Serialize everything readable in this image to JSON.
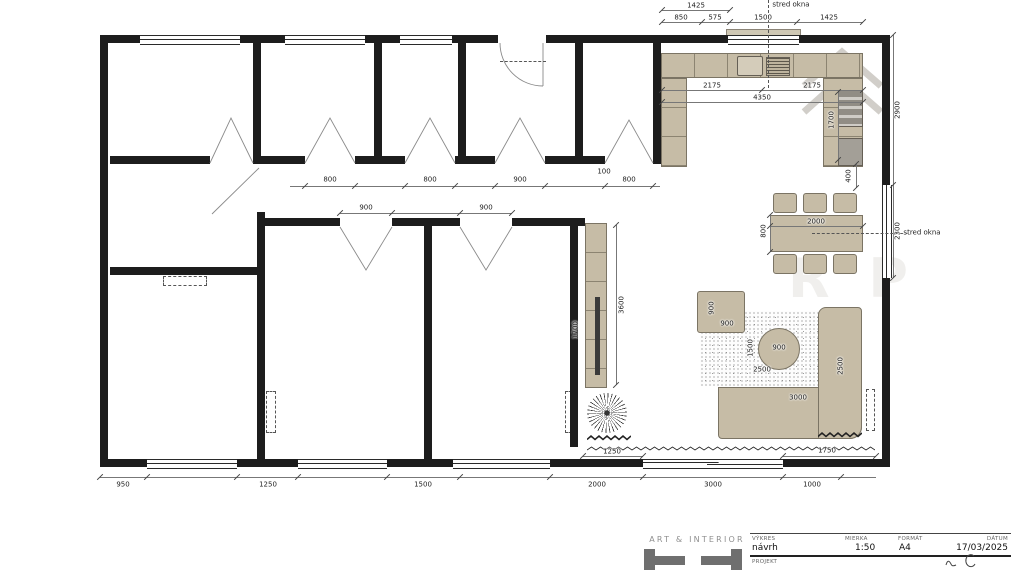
{
  "drawing": {
    "watermark_letters": "R P",
    "dim_labels": [
      {
        "t": "1425",
        "x": 696,
        "y": 6
      },
      {
        "t": "850",
        "x": 681,
        "y": 18
      },
      {
        "t": "575",
        "x": 715,
        "y": 18
      },
      {
        "t": "1500",
        "x": 763,
        "y": 18
      },
      {
        "t": "1425",
        "x": 829,
        "y": 18
      },
      {
        "t": "stred okna",
        "x": 791,
        "y": 5,
        "a": 1
      },
      {
        "t": "2175",
        "x": 712,
        "y": 86
      },
      {
        "t": "2175",
        "x": 812,
        "y": 86
      },
      {
        "t": "4350",
        "x": 762,
        "y": 98
      },
      {
        "t": "1700",
        "x": 832,
        "y": 120,
        "v": 1
      },
      {
        "t": "400",
        "x": 849,
        "y": 176,
        "v": 1
      },
      {
        "t": "2900",
        "x": 898,
        "y": 110,
        "v": 1
      },
      {
        "t": "2300",
        "x": 898,
        "y": 231,
        "v": 1
      },
      {
        "t": "stred okna",
        "x": 922,
        "y": 233,
        "a": 1
      },
      {
        "t": "2000",
        "x": 816,
        "y": 222
      },
      {
        "t": "800",
        "x": 764,
        "y": 231,
        "v": 1
      },
      {
        "t": "800",
        "x": 330,
        "y": 180
      },
      {
        "t": "800",
        "x": 430,
        "y": 180
      },
      {
        "t": "900",
        "x": 520,
        "y": 180
      },
      {
        "t": "100",
        "x": 604,
        "y": 172
      },
      {
        "t": "800",
        "x": 629,
        "y": 180
      },
      {
        "t": "900",
        "x": 366,
        "y": 208
      },
      {
        "t": "900",
        "x": 486,
        "y": 208
      },
      {
        "t": "3600",
        "x": 622,
        "y": 305,
        "v": 1
      },
      {
        "t": "1700",
        "x": 576,
        "y": 330,
        "v": 1
      },
      {
        "t": "900",
        "x": 712,
        "y": 308,
        "v": 1
      },
      {
        "t": "900",
        "x": 727,
        "y": 324
      },
      {
        "t": "900",
        "x": 779,
        "y": 348
      },
      {
        "t": "1500",
        "x": 751,
        "y": 348,
        "v": 1
      },
      {
        "t": "2500",
        "x": 762,
        "y": 370
      },
      {
        "t": "2500",
        "x": 841,
        "y": 366,
        "v": 1
      },
      {
        "t": "3000",
        "x": 798,
        "y": 398
      },
      {
        "t": "1250",
        "x": 612,
        "y": 452
      },
      {
        "t": "1750",
        "x": 827,
        "y": 451
      },
      {
        "t": "950",
        "x": 123,
        "y": 485
      },
      {
        "t": "1250",
        "x": 268,
        "y": 485
      },
      {
        "t": "1500",
        "x": 423,
        "y": 485
      },
      {
        "t": "2000",
        "x": 597,
        "y": 485
      },
      {
        "t": "3000",
        "x": 713,
        "y": 485
      },
      {
        "t": "1000",
        "x": 812,
        "y": 485
      }
    ]
  },
  "title_block": {
    "brand": "ART & INTERIOR",
    "fields": [
      {
        "label": "VÝKRES",
        "value": "návrh"
      },
      {
        "label": "MIERKA",
        "value": "1:50"
      },
      {
        "label": "FORMÁT",
        "value": "A4"
      },
      {
        "label": "DÁTUM",
        "value": "17/03/2025"
      }
    ],
    "project_label": "PROJEKT"
  }
}
